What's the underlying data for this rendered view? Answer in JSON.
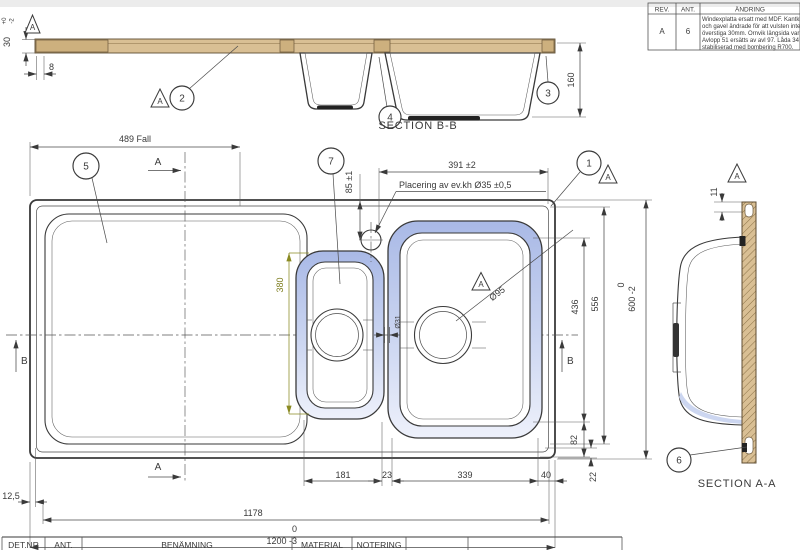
{
  "colors": {
    "wood": "#d9bf94",
    "rim_blue": "#b9c6ec",
    "olive_dim": "#7d7d1e",
    "line": "#3a3a3a"
  },
  "revision_table": {
    "headers": [
      "REV.",
      "ANT.",
      "ÄNDRING"
    ],
    "row": {
      "rev": "A",
      "ant": "6",
      "lines": [
        "Windexplatta ersatt med MDF. Kantklipp, ra",
        "och gavel ändrade för att vulsten inte ska",
        "överstiga 30mm. Ornvik längsida var 9mm.",
        "Avlopp 51 ersätts av avl 97. Låda 34",
        "stabiliserad med bombering R700."
      ]
    }
  },
  "section_bb": {
    "label": "SECTION B-B",
    "dim_thickness": {
      "value": "30",
      "tol_hi": "+0",
      "tol_lo": "-2"
    },
    "dim_edge": "8",
    "dim_depth": "160"
  },
  "section_aa": {
    "label": "SECTION A-A",
    "dim_lip": "11"
  },
  "plan": {
    "dim_fall": "489 Fall",
    "dim_width_top": "391 ±2",
    "note_hole": "Placering av ev.kh Ø35 ±0,5",
    "dim_hole_offset": "85 ±1",
    "dim_bowl_small_len": "380",
    "dim_drain_large": "Ø95",
    "dim_drain_small": "Ø31",
    "dim_436": "436",
    "dim_556": "556",
    "dim_600_hi": "0",
    "dim_600": "600 -2",
    "dim_82": "82",
    "dim_22": "22",
    "dim_181": "181",
    "dim_23": "23",
    "dim_339": "339",
    "dim_40": "40",
    "dim_1178": "1178",
    "dim_1200_hi": "0",
    "dim_1200": "1200 -3",
    "dim_12_5": "12,5"
  },
  "balloons": {
    "b1": "1",
    "b2": "2",
    "b3": "3",
    "b4": "4",
    "b5": "5",
    "b6": "6",
    "b7": "7"
  },
  "datum": {
    "letter": "A"
  },
  "section_marks": {
    "a": "A",
    "b": "B"
  },
  "title_block": {
    "headers": [
      "DET.NR",
      "ANT.",
      "BENÄMNING",
      "MATERIAL",
      "NOTERING"
    ]
  }
}
